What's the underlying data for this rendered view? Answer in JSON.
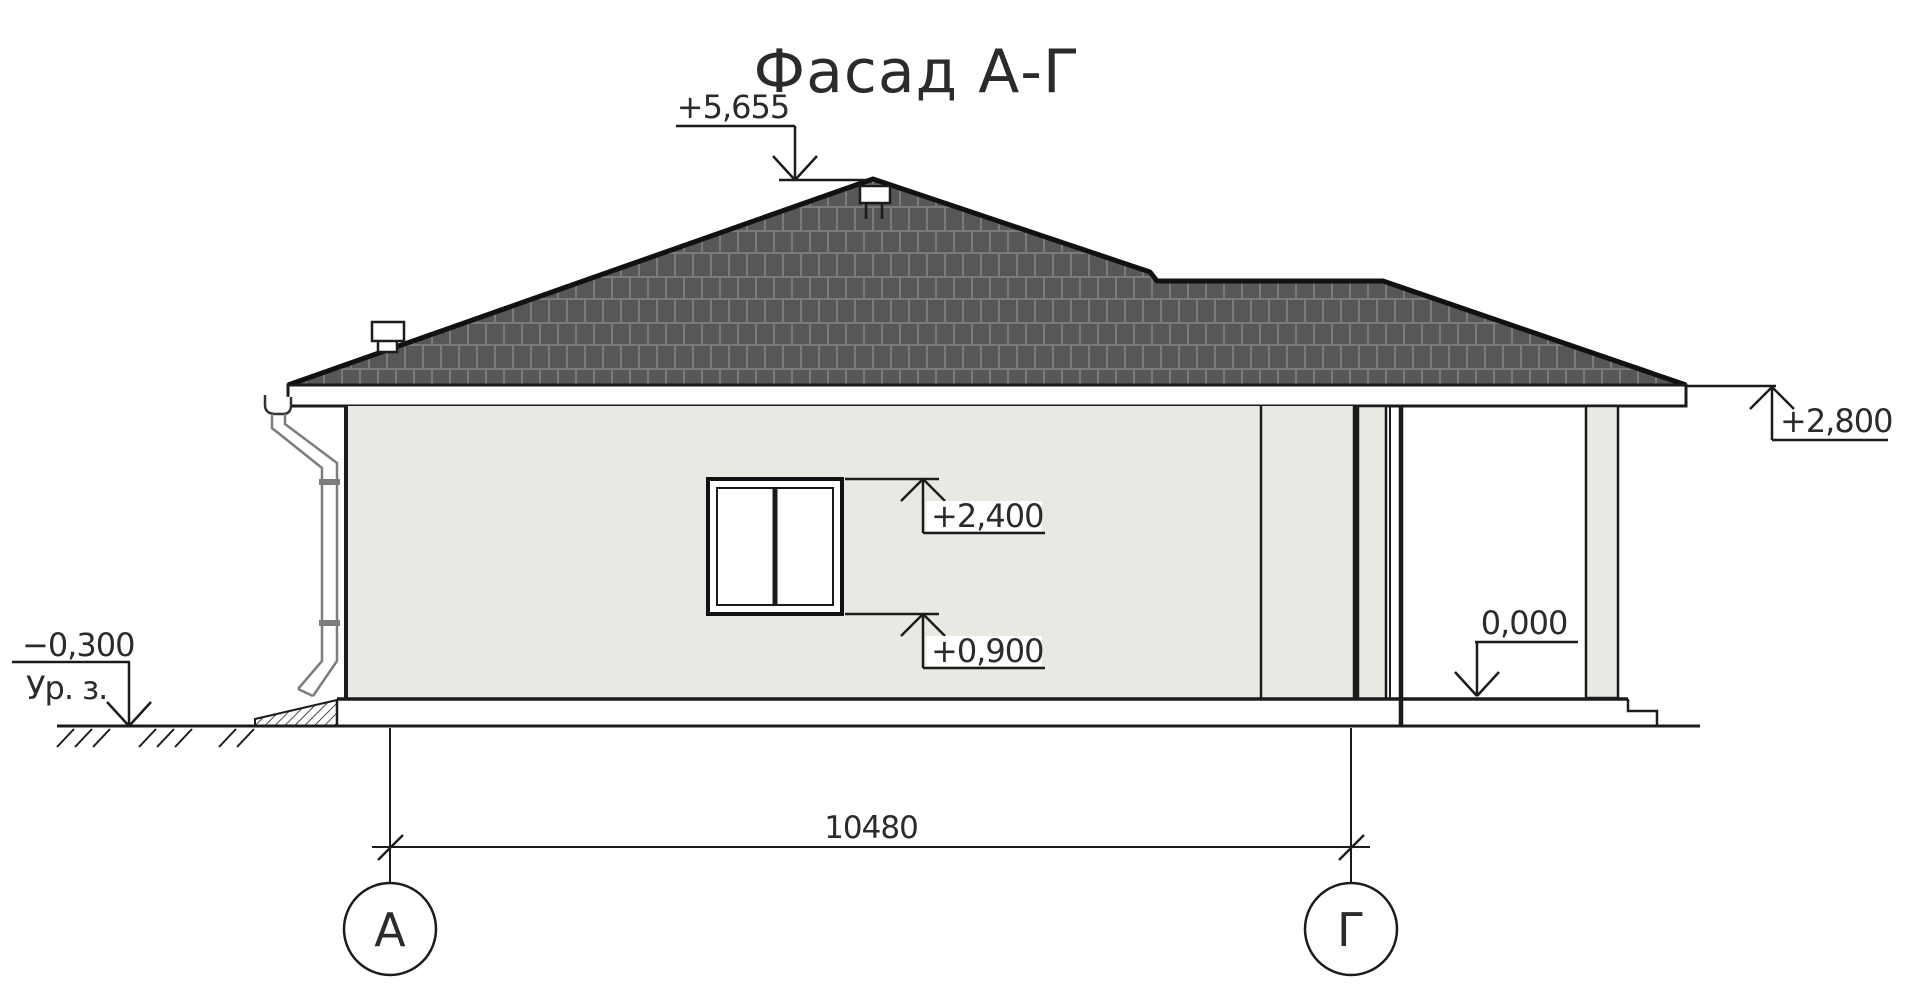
{
  "drawing": {
    "title": "Фасад А-Г"
  },
  "elevation_marks": {
    "roof_peak": "+5,655",
    "eaves": "+2,800",
    "window_head": "+2,400",
    "window_sill": "+0,900",
    "porch_floor": "0,000",
    "ground_level": "−0,300",
    "ground_level_caption": "Ур. з."
  },
  "dimension": {
    "between_axes": "10480"
  },
  "axes": {
    "left_label": "А",
    "right_label": "Г"
  },
  "colors": {
    "background": "#ffffff",
    "wall_fill": "#e9e9e4",
    "roof_fill": "#575757",
    "roof_tile_line": "#7b7b7b",
    "outline": "#1b1b1b",
    "downpipe": "#7d7d7d"
  }
}
